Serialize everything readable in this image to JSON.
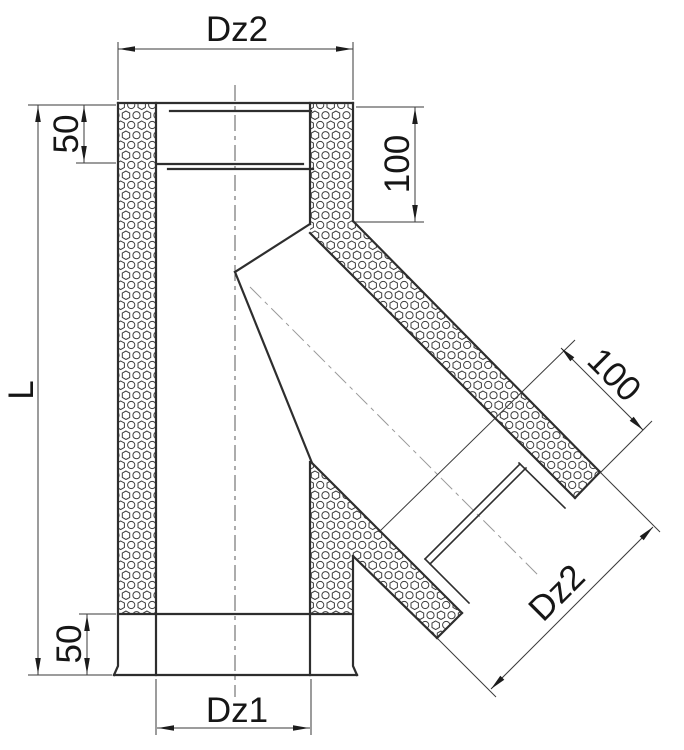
{
  "drawing": {
    "type": "technical-cross-section",
    "subject": "insulated 45-degree chimney tee, double-wall pipe with mineral-wool insulation",
    "labels": {
      "dz2_top": "Dz2",
      "socket_depth_top": "50",
      "top_right_offset": "100",
      "total_length": "L",
      "socket_depth_bottom": "50",
      "dz1_bottom": "Dz1",
      "branch_insert_depth": "100",
      "branch_outer_diameter": "Dz2"
    }
  }
}
